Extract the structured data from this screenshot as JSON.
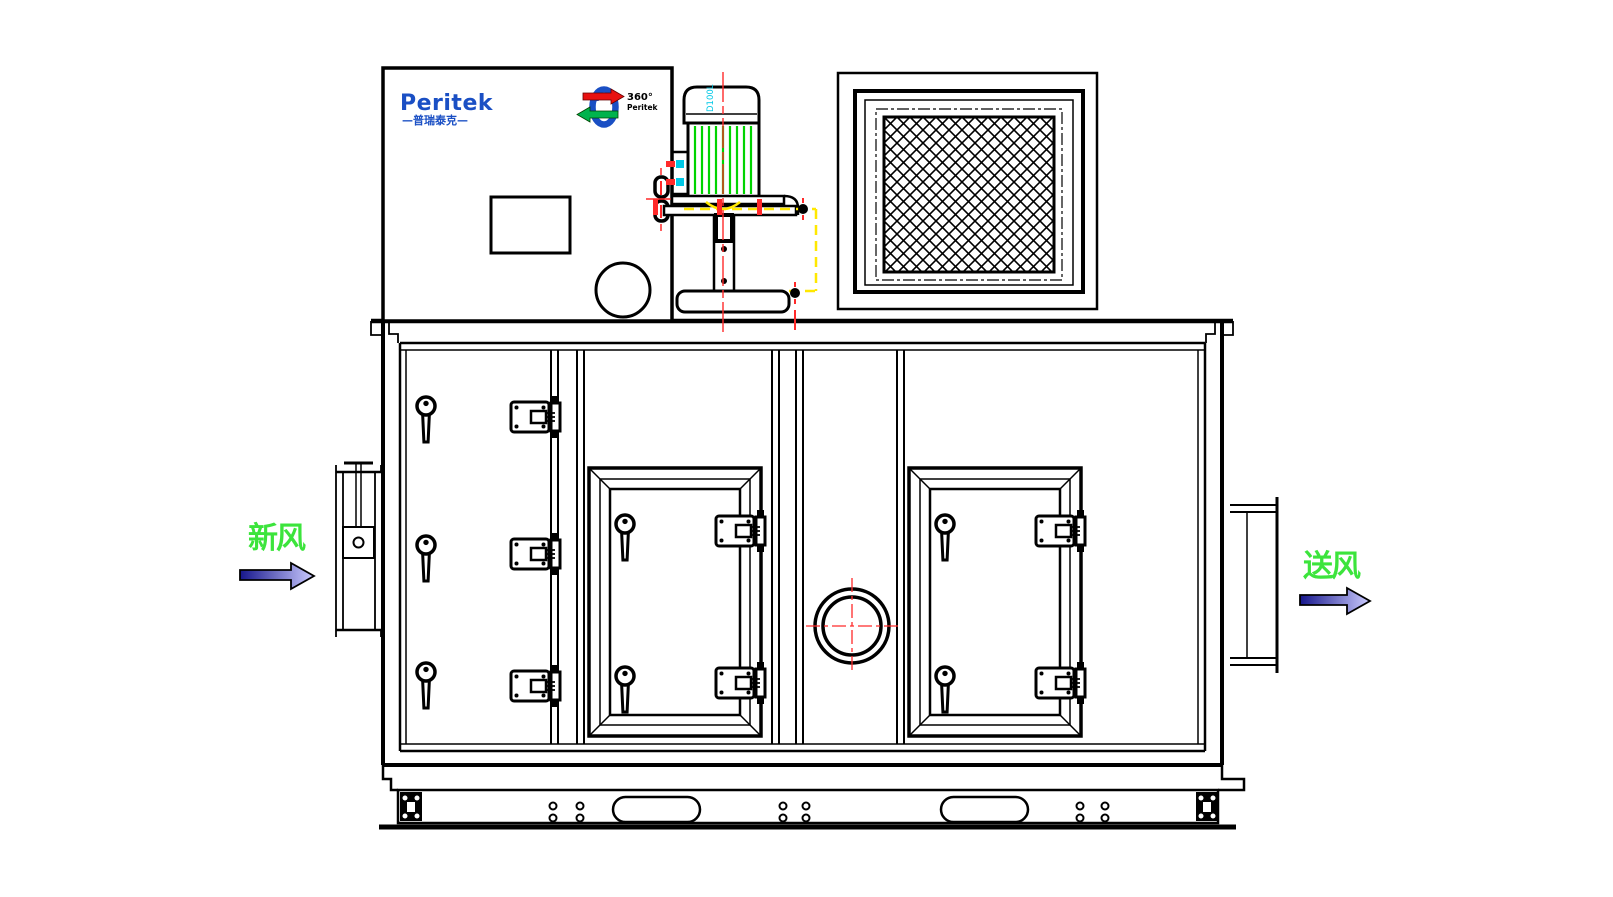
{
  "drawing": {
    "type": "engineering-front-elevation",
    "subject": "rotary dehumidifier air handling unit"
  },
  "brand": {
    "logo_text": "Peritek",
    "logo_subtext": "—普瑞泰克—",
    "badge": {
      "line1": "360°",
      "line2": "Peritek"
    }
  },
  "motor": {
    "frame_label": "D100L"
  },
  "flow_labels": {
    "inlet": "新风",
    "outlet": "送风"
  },
  "colors": {
    "brand_blue": "#1a4fc4",
    "centerline_red": "#ff2a2a",
    "hidden_yellow": "#ffe800",
    "fin_green": "#00d400",
    "label_green": "#3ce43c",
    "cyan_label": "#00c8e6",
    "arrow_dark": "#16168c",
    "arrow_light": "#ccccff",
    "badge_red": "#e81111",
    "badge_green": "#00b34d",
    "line_black": "#000000"
  }
}
